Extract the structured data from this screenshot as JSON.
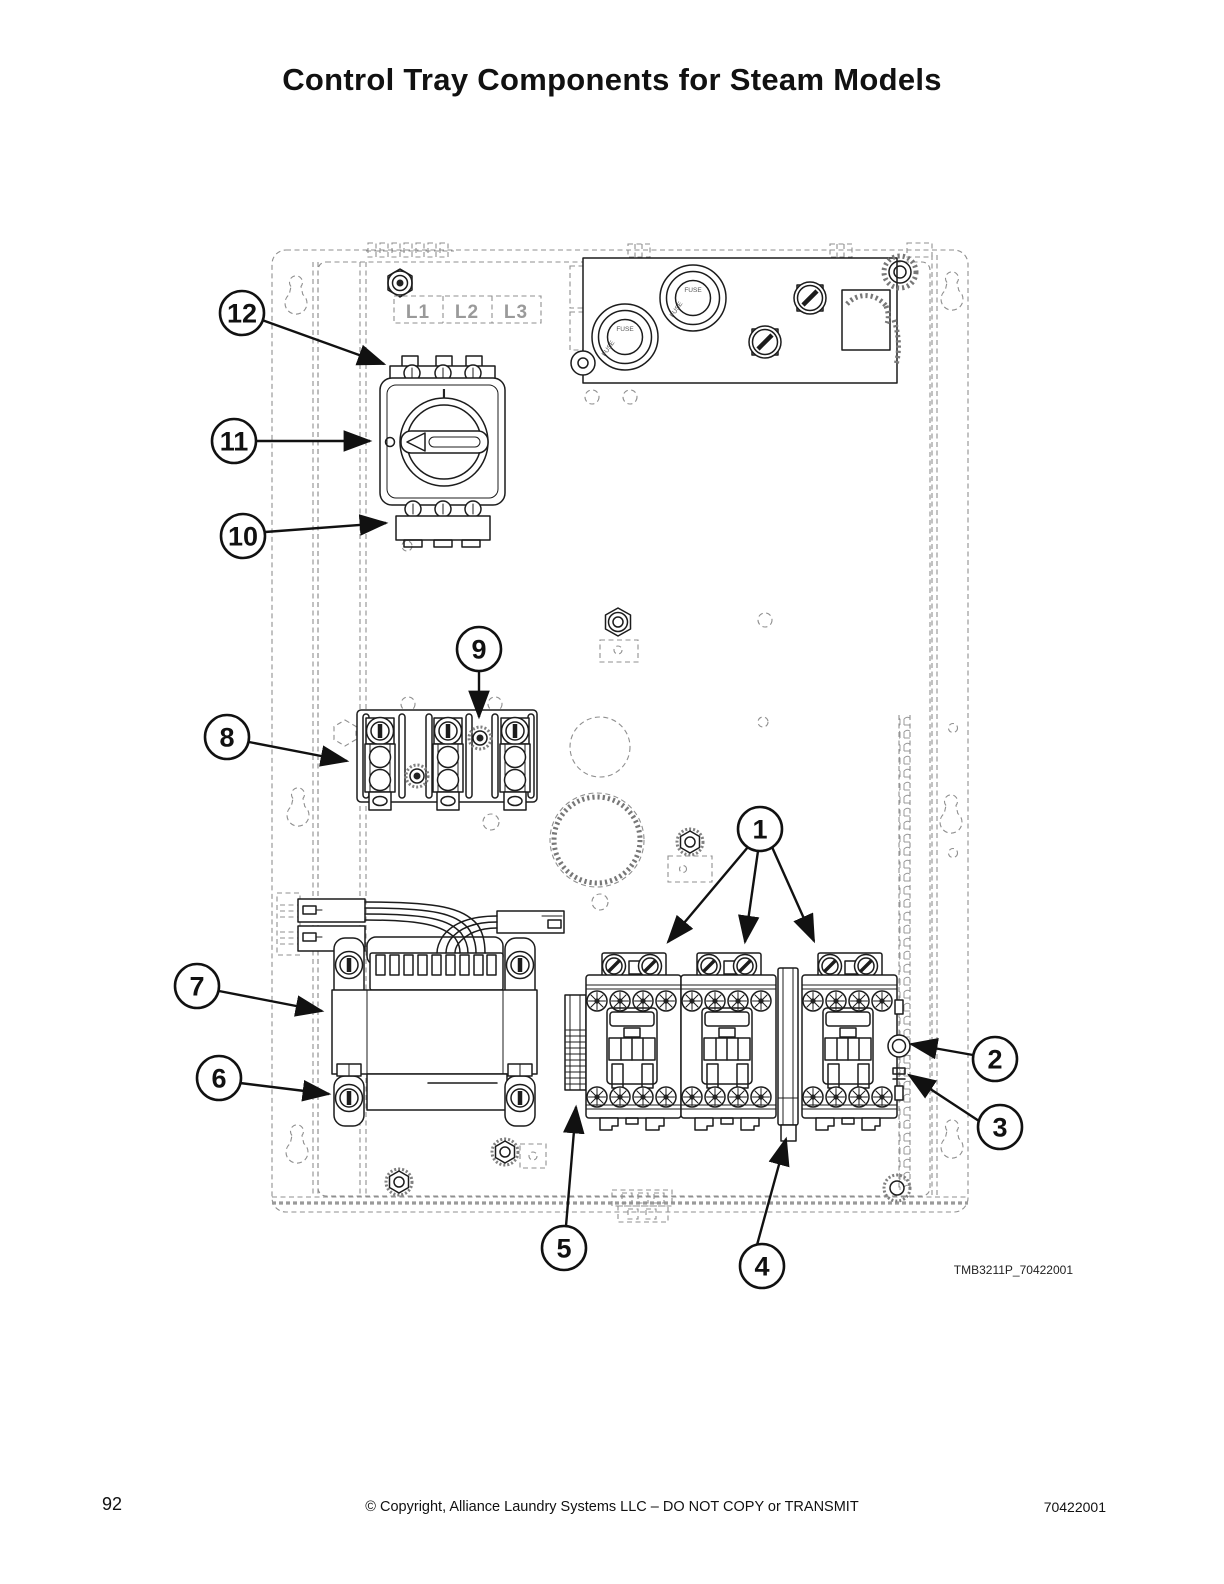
{
  "page": {
    "title": "Control Tray Components for Steam Models"
  },
  "figure": {
    "code": "TMB3211P_70422001",
    "terminal_labels": [
      "L1",
      "L2",
      "L3"
    ],
    "fuse_label": "FUSE",
    "switch_on_label": "I"
  },
  "callouts": [
    "1",
    "2",
    "3",
    "4",
    "5",
    "6",
    "7",
    "8",
    "9",
    "10",
    "11",
    "12"
  ],
  "footer": {
    "page_number": "92",
    "copyright": "© Copyright, Alliance Laundry Systems LLC – DO NOT COPY or TRANSMIT",
    "doc_number": "70422001"
  }
}
